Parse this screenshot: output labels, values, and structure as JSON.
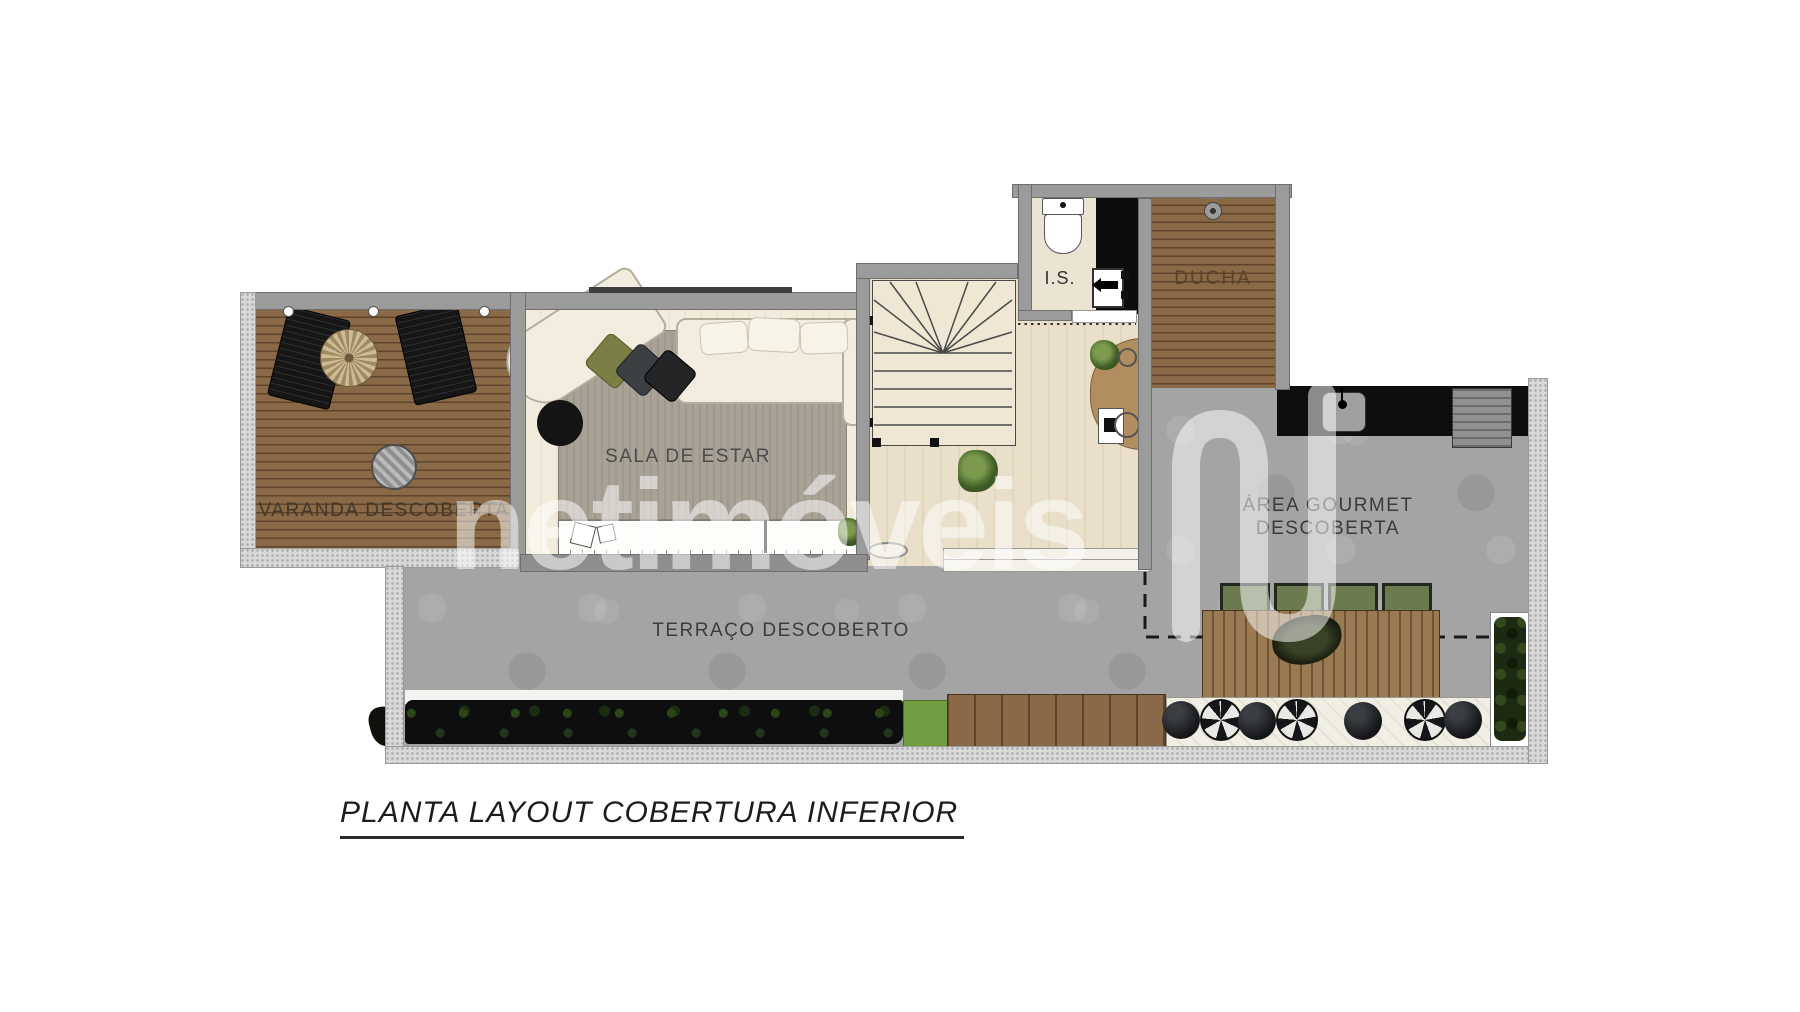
{
  "page": {
    "background": "#ffffff"
  },
  "title": {
    "text": "PLANTA LAYOUT COBERTURA INFERIOR"
  },
  "watermark": {
    "text": "netimóveis",
    "logo": "netimoveis-n-logo",
    "color": "#ffffff"
  },
  "rooms": {
    "varanda": {
      "label": "VARANDA DESCOBERTA"
    },
    "sala_de_estar": {
      "label": "SALA DE ESTAR"
    },
    "banheiro": {
      "label": "I.S."
    },
    "ducha": {
      "label": "DUCHA"
    },
    "area_gourmet": {
      "line1": "ÁREA GOURMET",
      "line2": "DESCOBERTA"
    },
    "terraco": {
      "label": "TERRAÇO DESCOBERTO"
    }
  },
  "furniture": [
    "sun-loungers",
    "parasol",
    "round-table",
    "l-shaped-sofa",
    "throw-pillows",
    "tv-console",
    "staircase",
    "toilet",
    "vanity-sink",
    "shower-head",
    "gourmet-counter-sink",
    "grill",
    "slatted-dining-table",
    "green-chairs",
    "poufs",
    "bench",
    "hedge",
    "planter",
    "wood-deck"
  ],
  "colors": {
    "wood_deck": "#8a6946",
    "concrete_floor": "#a4a4a4",
    "inner_wall": "#9b9b9b",
    "outer_wall": "#d9d9d9",
    "counter_black": "#0e0e0e",
    "sala_floor": "#f2ecdc",
    "hall_floor": "#eae0ca",
    "rug": "#a9a296",
    "hedge": "#0e0e0e",
    "grass": "#6f9d3f",
    "chair_green": "#6c7a50",
    "label_text": "#3f3f3f"
  }
}
